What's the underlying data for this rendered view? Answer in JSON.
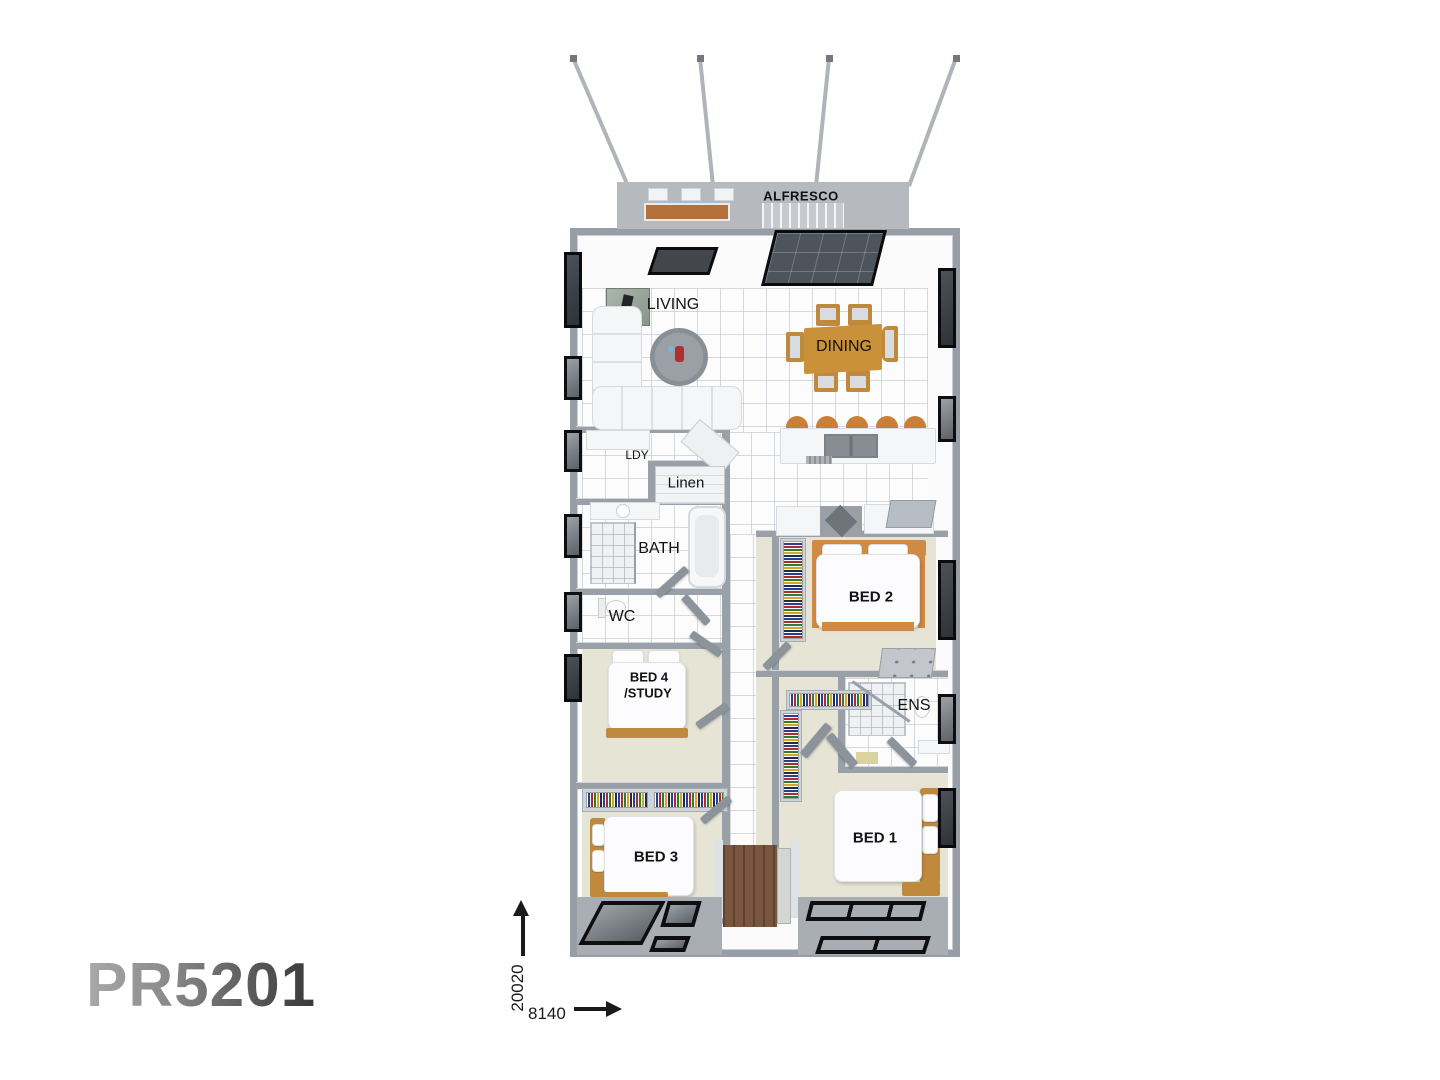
{
  "plan": {
    "code": "PR5201",
    "rooms": {
      "alfresco": "ALFRESCO",
      "living": "LIVING",
      "dining": "DINING",
      "laundry": "LDY",
      "linen": "Linen",
      "bath": "BATH",
      "wc": "WC",
      "bed4_line1": "BED 4",
      "bed4_line2": "/STUDY",
      "bed2": "BED 2",
      "ens": "ENS",
      "bed3": "BED 3",
      "bed1": "BED 1"
    },
    "dimensions": {
      "depth": "20020",
      "width": "8140"
    },
    "colors": {
      "wall_gray": "#99a0a8",
      "deck_gray": "#b6babe",
      "timber_accent": "#c08a3e",
      "dining_timber": "#c9913a",
      "carpet": "#e5e4d5",
      "window_frame": "#0e0e10",
      "label_text": "#121212"
    }
  }
}
